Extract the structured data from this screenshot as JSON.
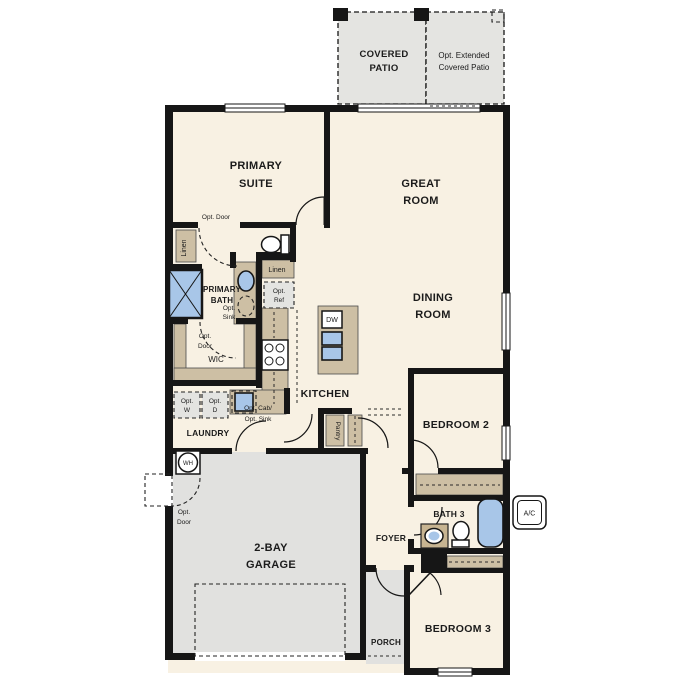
{
  "title": "Single-story floor plan",
  "colors": {
    "wall": "#161616",
    "room_fill": "#f8f1e3",
    "patio_fill": "#e4e4e1",
    "garage_fill": "#e1e1df",
    "cabinet_fill": "#cdbfa4",
    "cabinet_dark": "#c7b491",
    "fixture_blue": "#a8c6e8",
    "optbox_fill": "#e4e4e1",
    "text_color": "#1b1b1b"
  },
  "labels": {
    "covered_patio": [
      "COVERED",
      "PATIO"
    ],
    "extended_patio": [
      "Opt. Extended",
      "Covered Patio"
    ],
    "primary_suite": [
      "PRIMARY",
      "SUITE"
    ],
    "great_room": [
      "GREAT",
      "ROOM"
    ],
    "dining_room": [
      "DINING",
      "ROOM"
    ],
    "primary_bath": [
      "PRIMARY",
      "BATH"
    ],
    "opt_door": "Opt. Door",
    "opt_door_2l": [
      "Opt.",
      "Door"
    ],
    "linen": "Linen",
    "opt_sink_2l": [
      "Opt.",
      "Sink"
    ],
    "opt_ref_2l": [
      "Opt.",
      "Ref"
    ],
    "wic": "WIC",
    "kitchen": "KITCHEN",
    "dw": "DW",
    "pantry": "Pantry",
    "laundry": "LAUNDRY",
    "opt_w_2l": [
      "Opt.",
      "W"
    ],
    "opt_d_2l": [
      "Opt.",
      "D"
    ],
    "opt_cab_sink_2l": [
      "Opt. Cab/",
      "Opt. Sink"
    ],
    "bedroom2": "BEDROOM 2",
    "bath3": "BATH 3",
    "ac": "A/C",
    "wh": "WH",
    "garage": [
      "2-BAY",
      "GARAGE"
    ],
    "foyer": "FOYER",
    "porch": "PORCH",
    "bedroom3": "BEDROOM 3"
  }
}
